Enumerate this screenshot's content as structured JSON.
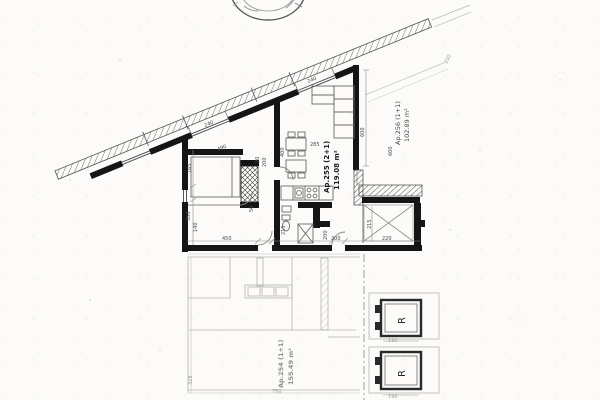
{
  "drawing": {
    "type": "architectural floor plan (scanned)",
    "ink_color": "#151515",
    "faint_color": "#9a9a98"
  },
  "units": [
    {
      "name": "Ap.255 (2+1)",
      "area": "119.08 m²"
    },
    {
      "name": "Ap.256 (1+1)",
      "area": "102.89 m²"
    },
    {
      "name": "Ap.254 (1+1)",
      "area": "155.49 m²"
    }
  ],
  "elevators": [
    {
      "label": "R"
    },
    {
      "label": "R"
    }
  ],
  "dims": [
    {
      "t": "165"
    },
    {
      "t": "490"
    },
    {
      "t": "350"
    },
    {
      "t": "140"
    },
    {
      "t": "450"
    },
    {
      "t": "400"
    },
    {
      "t": "285"
    },
    {
      "t": "215"
    },
    {
      "t": "200"
    },
    {
      "t": "200"
    },
    {
      "t": "215"
    },
    {
      "t": "220"
    },
    {
      "t": "600"
    },
    {
      "t": "600"
    },
    {
      "t": "240"
    },
    {
      "t": "240"
    },
    {
      "t": "200"
    },
    {
      "t": "90"
    },
    {
      "t": "200"
    },
    {
      "t": "50"
    },
    {
      "t": "328"
    },
    {
      "t": "750"
    },
    {
      "t": "190"
    },
    {
      "t": "190"
    }
  ]
}
